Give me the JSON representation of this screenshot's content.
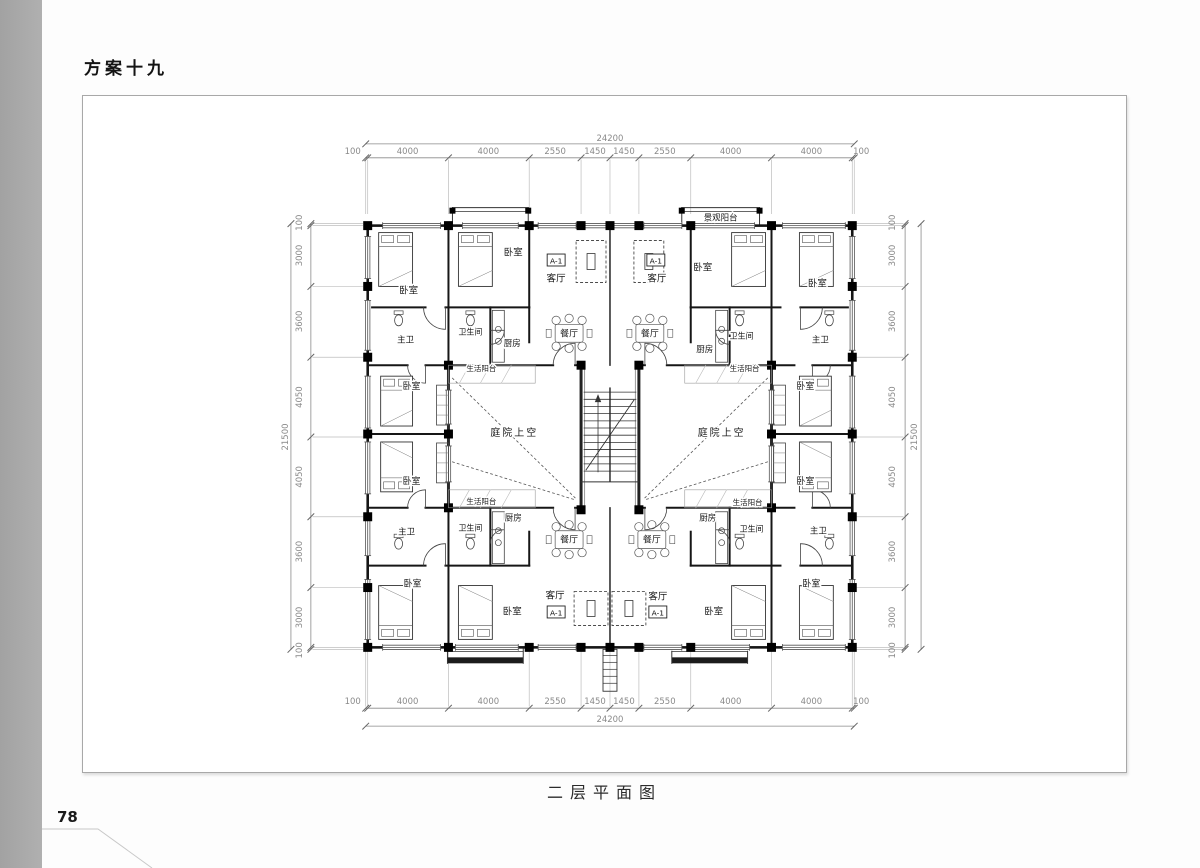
{
  "page": {
    "title": "方案十九",
    "caption": "二层平面图",
    "page_number": "78"
  },
  "plan": {
    "unit_tag": "A-1",
    "rooms": {
      "bedroom": "卧室",
      "master_bath": "主卫",
      "bath": "卫生间",
      "kitchen": "厨房",
      "dining": "餐厅",
      "living": "客厅",
      "courtyard": "庭院上空",
      "service_balcony": "生活阳台",
      "view_balcony": "景观阳台"
    }
  },
  "dimensions": {
    "horizontal": {
      "total": "24200",
      "segments": [
        "100",
        "4000",
        "4000",
        "2550",
        "1450",
        "1450",
        "2550",
        "4000",
        "4000",
        "100"
      ]
    },
    "vertical": {
      "total": "21500",
      "segments": [
        "100",
        "3000",
        "3600",
        "4050",
        "4050",
        "3600",
        "3000",
        "100"
      ]
    }
  }
}
